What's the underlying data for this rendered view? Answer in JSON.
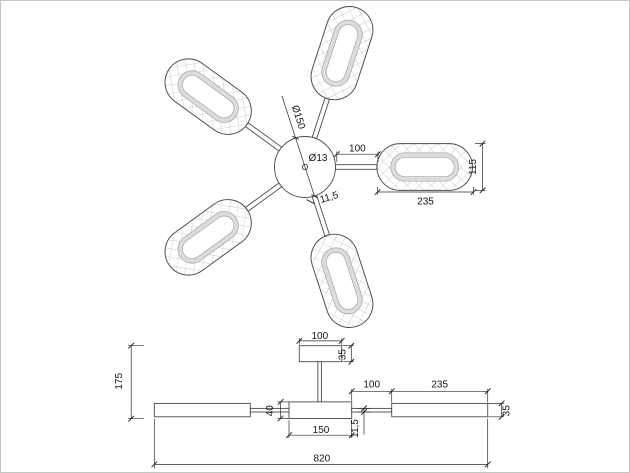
{
  "colors": {
    "background": "#ffffff",
    "outline": "#4a4a4a",
    "dimension": "#2b2b2b",
    "hatch": "#b8b8b8",
    "led_ring": "#dcdcdc",
    "page_border": "#c6c6c6"
  },
  "top_view": {
    "hub_diameter": "Ø150",
    "center_hole_diameter": "Ø13",
    "arm_length": "100",
    "shade_length": "235",
    "shade_width": "115",
    "arm_thickness": "11,5"
  },
  "front_view": {
    "canopy_width": "100",
    "canopy_height": "35",
    "overall_height": "175",
    "body_height": "40",
    "body_width": "150",
    "arm_thickness": "11,5",
    "arm_length": "100",
    "shade_length": "235",
    "shade_height": "35",
    "overall_width": "820"
  }
}
